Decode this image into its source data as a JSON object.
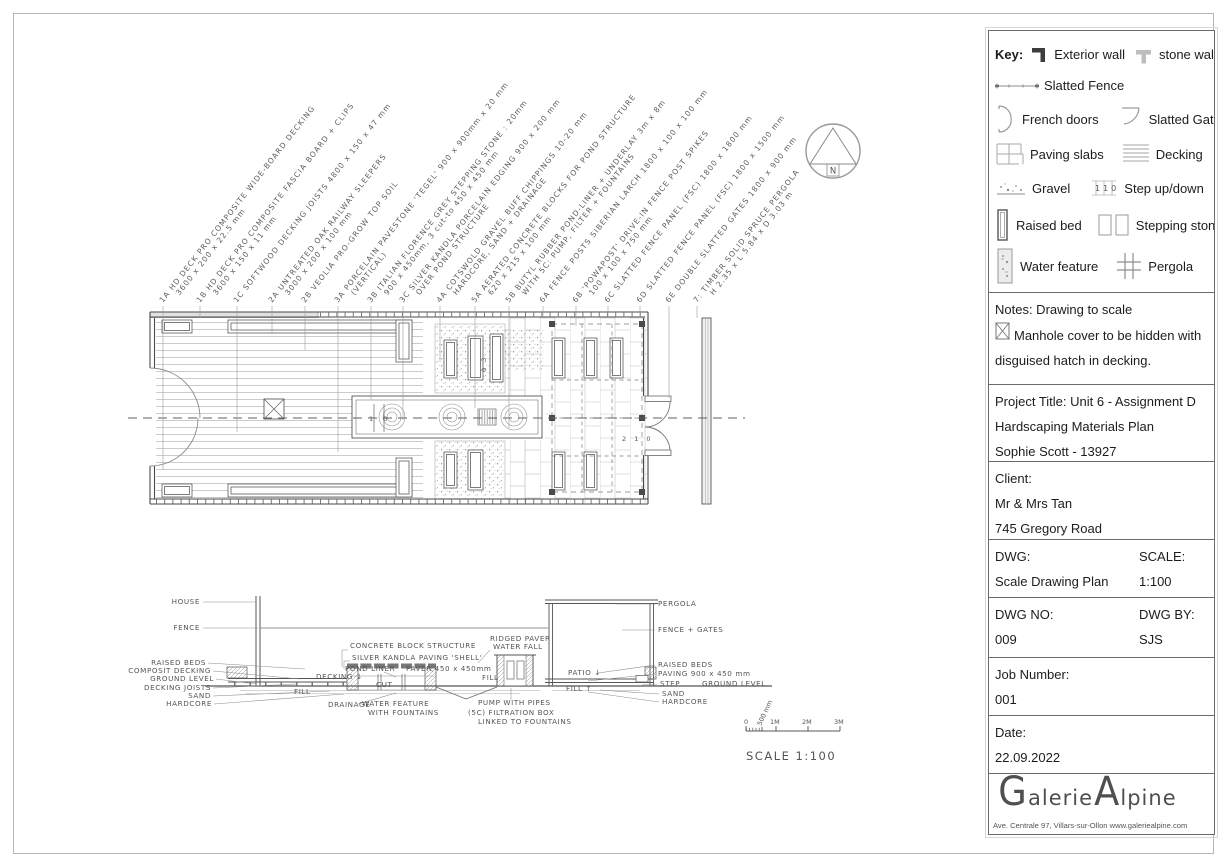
{
  "sidebar": {
    "key": {
      "title": "Key:",
      "step_icon_text": "110",
      "items": [
        {
          "icon": "exterior-wall-icon",
          "label": "Exterior wall"
        },
        {
          "icon": "stone-wall-icon",
          "label": "stone wall"
        },
        {
          "icon": "slatted-fence-icon",
          "label": "Slatted Fence"
        },
        {
          "icon": "french-doors-icon",
          "label": "French doors"
        },
        {
          "icon": "slatted-gates-icon",
          "label": "Slatted Gates"
        },
        {
          "icon": "paving-slabs-icon",
          "label": "Paving slabs"
        },
        {
          "icon": "decking-icon",
          "label": "Decking"
        },
        {
          "icon": "gravel-icon",
          "label": "Gravel"
        },
        {
          "icon": "step-up-down-icon",
          "label": "Step up/down"
        },
        {
          "icon": "raised-bed-icon",
          "label": "Raised bed"
        },
        {
          "icon": "stepping-stone-icon",
          "label": "Stepping stone"
        },
        {
          "icon": "water-feature-icon",
          "label": "Water feature"
        },
        {
          "icon": "pergola-icon",
          "label": "Pergola"
        },
        {
          "icon": "drain-icon",
          "label": "Drain"
        },
        {
          "icon": "fountain-icon",
          "label": "Fountain"
        }
      ]
    },
    "notes": {
      "line1": "Notes: Drawing to scale",
      "line2": "Manhole cover to be hidden with",
      "line3": "disguised hatch in decking."
    },
    "project": {
      "line1": "Project Title:  Unit 6 - Assignment D",
      "line2": "Hardscaping Materials Plan",
      "line3": "Sophie Scott - 13927"
    },
    "client": {
      "label": "Client:",
      "line1": "Mr & Mrs Tan",
      "line2": "745 Gregory Road"
    },
    "dwg": {
      "label": "DWG:",
      "value": "Scale Drawing Plan",
      "scale_label": "SCALE:",
      "scale_value": "1:100"
    },
    "dwgno": {
      "label": "DWG NO:",
      "value": "009",
      "by_label": "DWG BY:",
      "by_value": "SJS"
    },
    "job": {
      "label": "Job Number:",
      "value": "001"
    },
    "date": {
      "label": "Date:",
      "value": "22.09.2022"
    },
    "logo": {
      "part1": "G",
      "part2": "alerie ",
      "part3": "A",
      "part4": "lpine",
      "address": "Ave. Centrale 97, Villars-sur-Ollon  www.galeriealpine.com"
    }
  },
  "materials_labels": [
    {
      "label": "1A  HD DECK PRO COMPOSITE WIDE-BOARD DECKING",
      "dims": "3600 x 200 x 22.5 mm"
    },
    {
      "label": "1B  HD DECK PRO COMPOSITE FASCIA BOARD + CLIPS",
      "dims": "3600 x 150 x 11 mm"
    },
    {
      "label": "1C  SOFTWOOD DECKING JOISTS 4800 x 150 x 47 mm",
      "dims": ""
    },
    {
      "label": "2A  UNTREATED OAK RAILWAY SLEEPERS",
      "dims": "3000 x 200 x 100 mm"
    },
    {
      "label": "2B  VEOLIA PRO-GROW TOP SOIL",
      "dims": ""
    },
    {
      "label": "3A  PORCELAIN PAVESTONE 'TEGEL' 900 x 900mm x 20 mm",
      "dims": "(VERTICAL)"
    },
    {
      "label": "3B  ITALIAN FLORENCE GREY STEPPING STONE : 20mm",
      "dims": "900 x 450mm, 3 cut-to 450 x 450 mm"
    },
    {
      "label": "3C  SILVER KANDLA PORCELAIN EDGING 900 x 200 mm",
      "dims": "OVER POND STRUCTURE"
    },
    {
      "label": "4A  COTSWOLD GRAVEL BUFF CHIPPINGS 10-20 mm",
      "dims": "HARDCORE, SAND + DRAINAGE"
    },
    {
      "label": "5A  AERATED CONCRETE BLOCKS FOR POND STRUCTURE",
      "dims": "620 x 215 x 100 mm"
    },
    {
      "label": "5B  BUTYL RUBBER POND-LINER + UNDERLAY 3m x 8m",
      "dims": "WITH 5C: PUMP, FILTER + FOUNTAINS"
    },
    {
      "label": "6A  FENCE POSTS SIBERIAN LARCH 1800 x 100 x 100 mm",
      "dims": ""
    },
    {
      "label": "6B  'POWAPOST' DRIVE-IN FENCE POST SPIKES",
      "dims": "100 x 100 x 750 mm"
    },
    {
      "label": "6C  SLATTED FENCE PANEL (FSC) 1800 x 1800 mm",
      "dims": ""
    },
    {
      "label": "6D  SLATTED FENCE PANEL (FSC) 1800 x 1500 mm",
      "dims": ""
    },
    {
      "label": "6E  DOUBLE SLATTED GATES 1800 x 900 mm",
      "dims": ""
    },
    {
      "label": "7:  TIMBER SOLID SPRUCE PERGOLA",
      "dims": "H 2.35 x L 5.84 x D 3.03 m"
    }
  ],
  "plan": {
    "step_left": "1 0",
    "step_mid": "0 3",
    "step_right": "2 1 0",
    "north_label": "N"
  },
  "section": {
    "left": [
      "HOUSE",
      "FENCE",
      "RAISED BEDS",
      "COMPOSIT DECKING",
      "GROUND LEVEL",
      "DECKING JOISTS",
      "SAND",
      "HARDCORE"
    ],
    "mid": {
      "concrete": "CONCRETE BLOCK STRUCTURE",
      "kandla": "SILVER KANDLA PAVING 'SHELL'",
      "pond_liner": "POND LINER",
      "paver": "PAVER 450 x 450mm",
      "ridged1": "RIDGED PAVER",
      "ridged2": "WATER FALL",
      "cut": "CUT",
      "fill_left": "FILL",
      "fill_mid": "FILL",
      "fill_right": "FILL ↑",
      "drainage": "DRAINAGE",
      "wf1": "WATER FEATURE",
      "wf2": "WITH FOUNTAINS",
      "pump": "PUMP WITH PIPES",
      "filtration": "(5C) FILTRATION BOX",
      "linked": "LINKED TO FOUNTAINS",
      "decking_arrow": "DECKING ↓",
      "patio_arrow": "PATIO ↓"
    },
    "right": [
      "PERGOLA",
      "FENCE + GATES",
      "RAISED BEDS",
      "PAVING 900 x 450 mm",
      "STEP",
      "GROUND LEVEL",
      "SAND",
      "HARDCORE"
    ]
  },
  "scale_bar": {
    "t0": "0",
    "t05": "500 mm",
    "t1": "1M",
    "t2": "2M",
    "t3": "3M",
    "caption": "SCALE 1:100"
  }
}
